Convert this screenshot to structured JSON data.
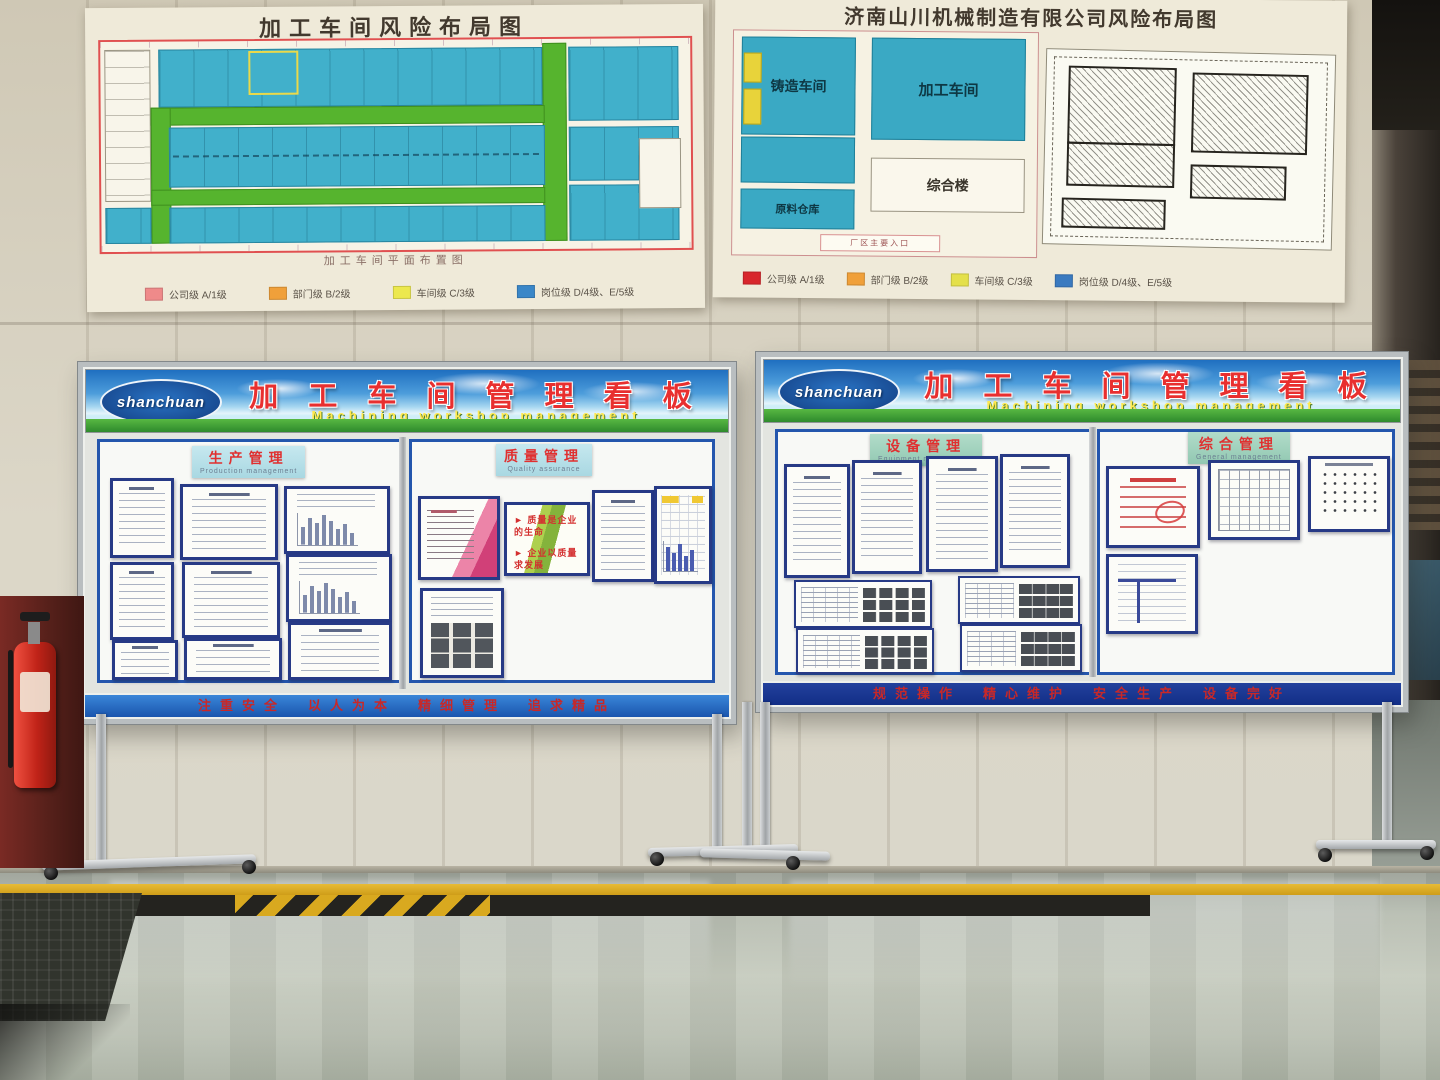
{
  "posters": {
    "left": {
      "title": "加工车间风险布局图",
      "caption": "加工车间平面布置图",
      "legend": [
        {
          "color": "#ef8a8a",
          "label": "公司级 A/1级"
        },
        {
          "color": "#f0a03a",
          "label": "部门级 B/2级"
        },
        {
          "color": "#ece84e",
          "label": "车间级 C/3级"
        },
        {
          "color": "#3a87c8",
          "label": "岗位级 D/4级、E/5级"
        }
      ]
    },
    "right": {
      "title": "济南山川机械制造有限公司风险布局图",
      "blocks": {
        "casting": "铸造车间",
        "machining": "加工车间",
        "office": "综合楼",
        "warehouse": "原料仓库"
      },
      "entrance_label": "厂区主要入口",
      "legend": [
        {
          "color": "#d8262c",
          "label": "公司级 A/1级"
        },
        {
          "color": "#f0a03a",
          "label": "部门级 B/2级"
        },
        {
          "color": "#e4e04a",
          "label": "车间级 C/3级"
        },
        {
          "color": "#3a7ac0",
          "label": "岗位级 D/4级、E/5级"
        }
      ]
    }
  },
  "boards": {
    "header": {
      "title_cn": "加 工 车 间 管 理 看 板",
      "title_en": "Machining workshop management",
      "logo_text": "shanchuan"
    },
    "left_board": {
      "section1": {
        "label": "生产管理",
        "sub": "Production management"
      },
      "section2": {
        "label": "质量管理",
        "sub": "Quality assurance"
      },
      "quality_slogan_line1": "► 质量是企业的生命",
      "quality_slogan_line2": "► 企业以质量求发展",
      "footer_slogan": "注重安全　以人为本　精细管理　追求精品"
    },
    "right_board": {
      "section1": {
        "label": "设备管理",
        "sub": "Equipment management"
      },
      "section2": {
        "label": "综合管理",
        "sub": "General management"
      },
      "footer_slogan": "规范操作　精心维护　安全生产　设备完好"
    }
  }
}
